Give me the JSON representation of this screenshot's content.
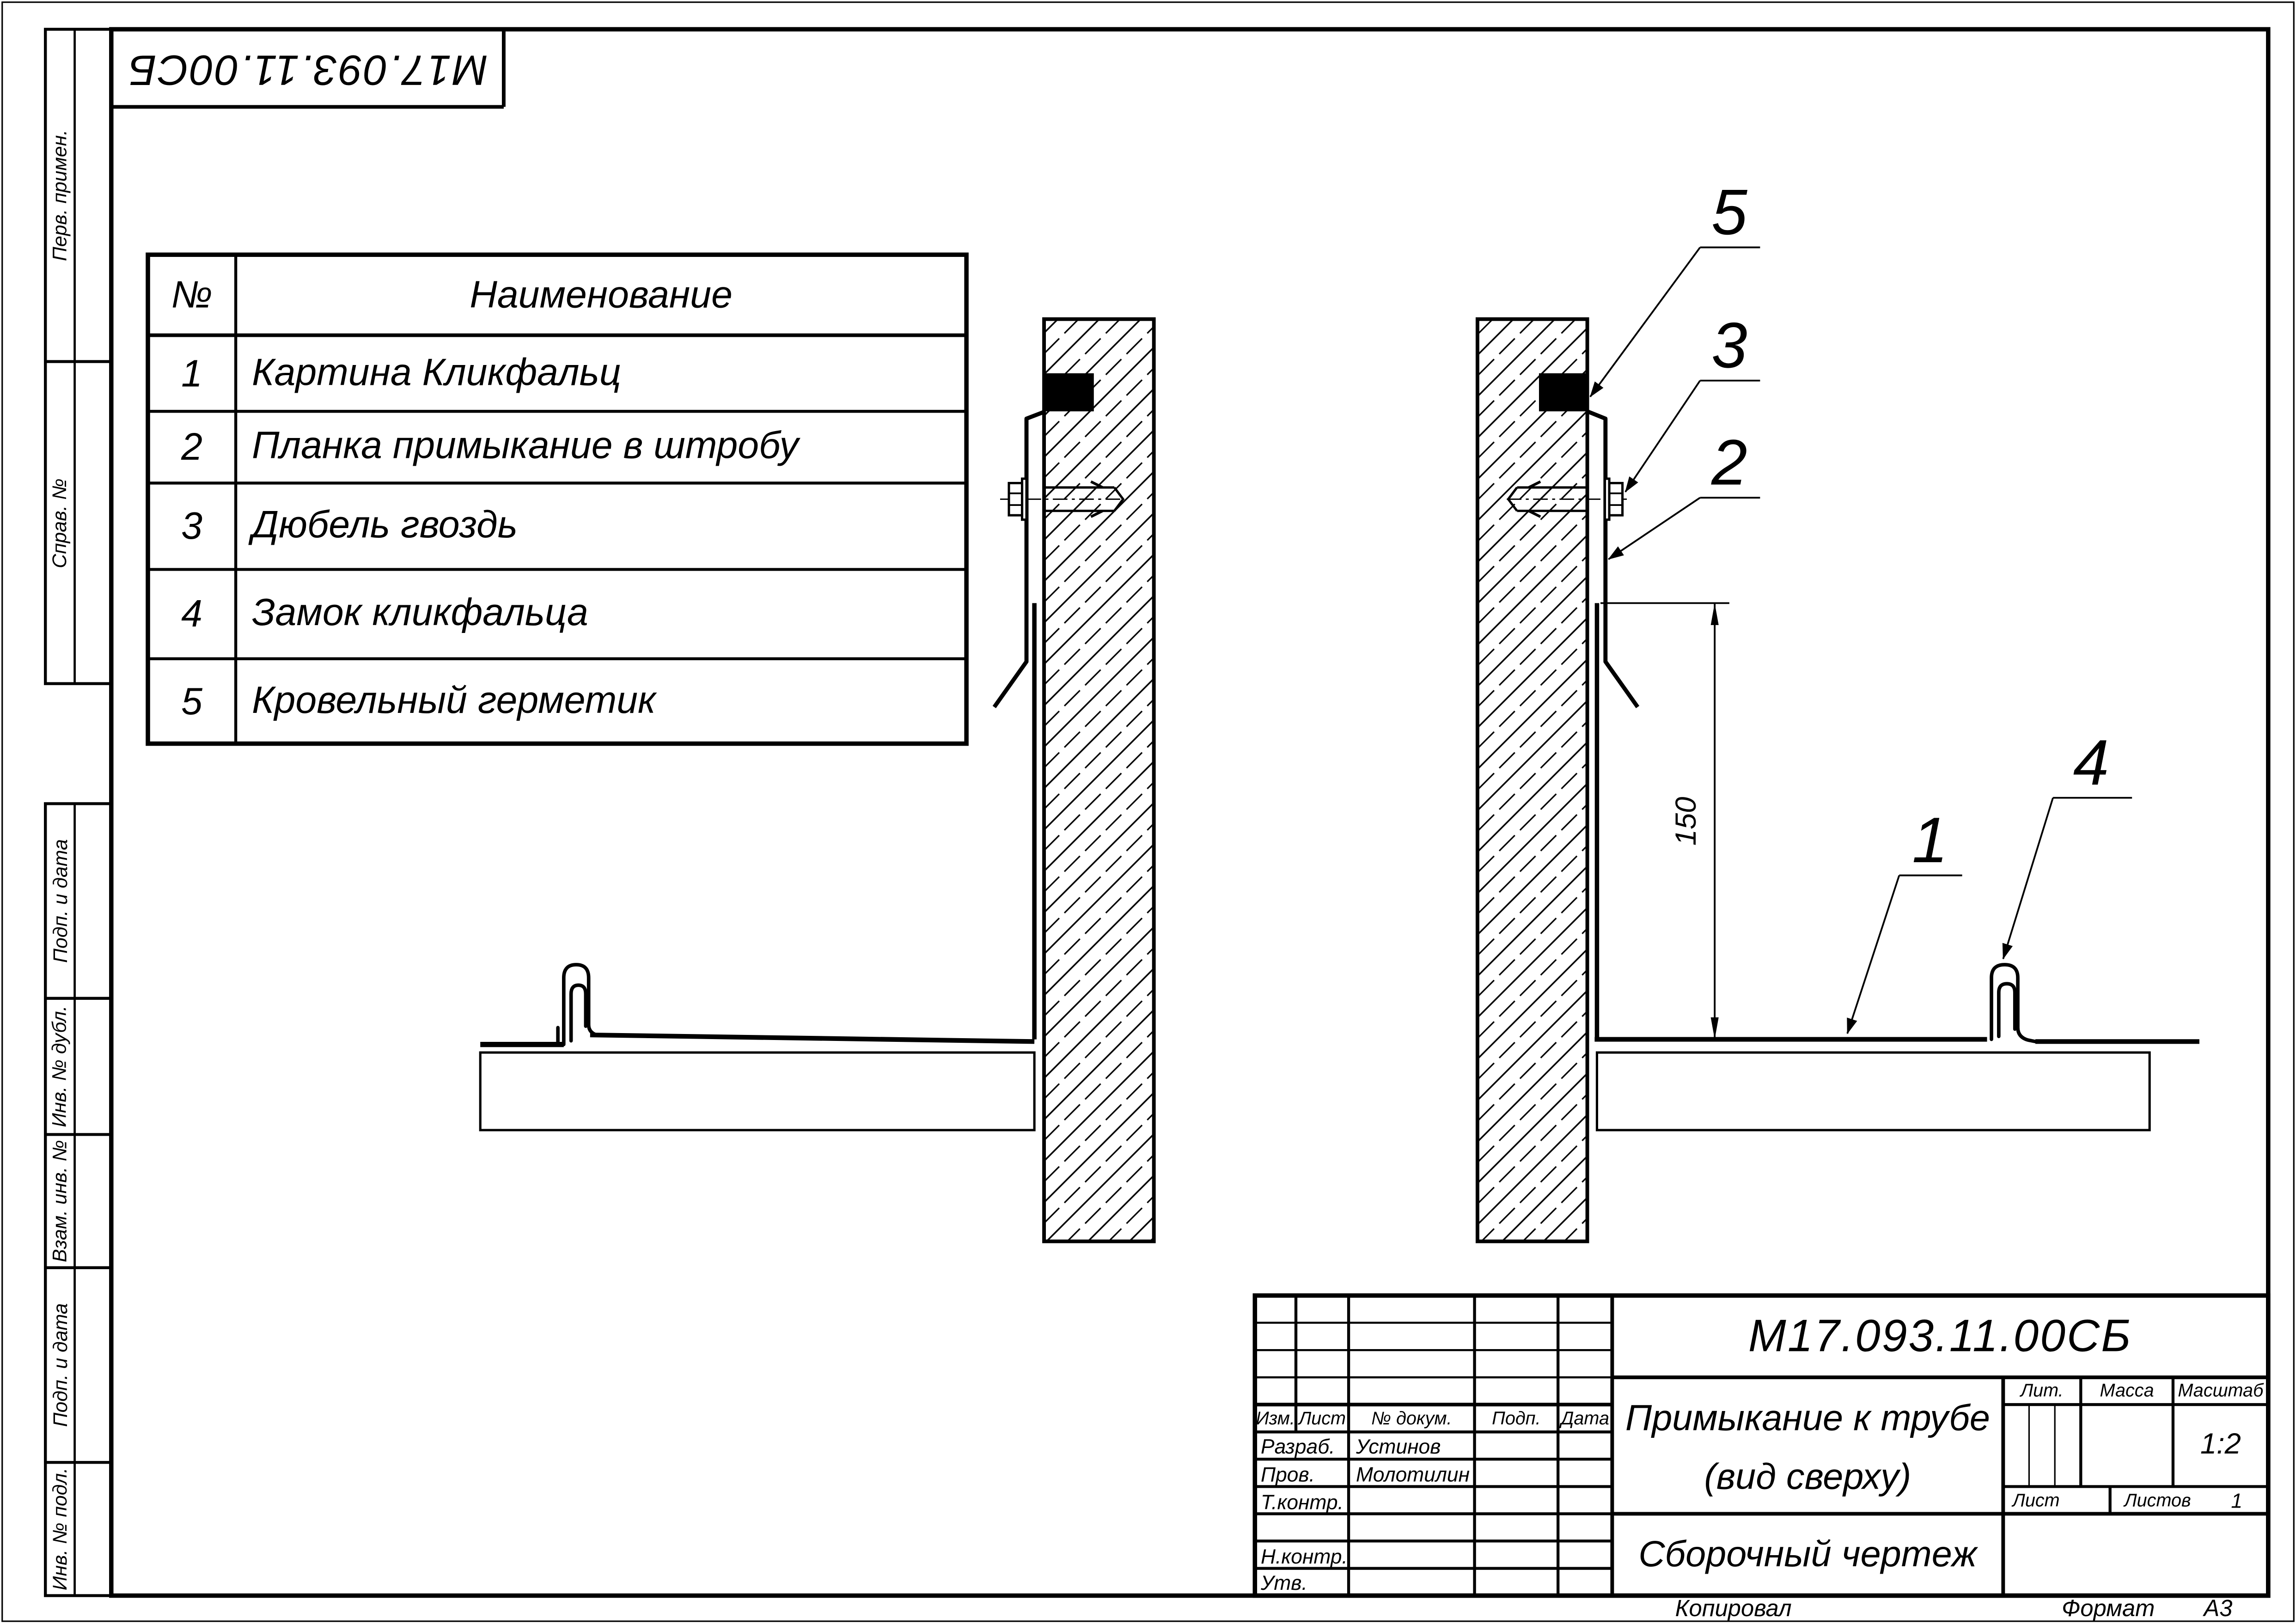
{
  "sheet": {
    "stamp_code": "М17.093.11.00СБ"
  },
  "margin_labels": [
    "Перв. примен.",
    "Справ. №",
    "Подп. и дата",
    "Инв. № дубл.",
    "Взам. инв. №",
    "Подп. и дата",
    "Инв. № подл."
  ],
  "parts_table": {
    "headers": {
      "num": "№",
      "name": "Наименование"
    },
    "rows": [
      {
        "num": "1",
        "name": "Картина Кликфальц"
      },
      {
        "num": "2",
        "name": "Планка примыкание в штробу"
      },
      {
        "num": "3",
        "name": "Дюбель гвоздь"
      },
      {
        "num": "4",
        "name": "Замок кликфальца"
      },
      {
        "num": "5",
        "name": "Кровельный герметик"
      }
    ]
  },
  "drawing": {
    "dimension_150": "150",
    "callout_1": "1",
    "callout_2": "2",
    "callout_3": "3",
    "callout_4": "4",
    "callout_5": "5"
  },
  "title_block": {
    "doc_number": "М17.093.11.00СБ",
    "title_line1": "Примыкание к трубе",
    "title_line2": "(вид сверху)",
    "doc_type": "Сборочный чертеж",
    "labels": {
      "izm": "Изм.",
      "list": "Лист",
      "n_dokum": "№ докум.",
      "podp": "Подп.",
      "data": "Дата",
      "razrab": "Разраб.",
      "prov": "Пров.",
      "t_kontr": "Т.контр.",
      "n_kontr": "Н.контр.",
      "utv": "Утв.",
      "lit": "Лит.",
      "massa": "Масса",
      "masshtab": "Масштаб",
      "list2": "Лист",
      "listov": "Листов"
    },
    "values": {
      "razrab_name": "Устинов",
      "prov_name": "Молотилин",
      "scale": "1:2",
      "listov_count": "1"
    }
  },
  "footer": {
    "kopiroval": "Копировал",
    "format_label": "Формат",
    "format_value": "А3"
  }
}
